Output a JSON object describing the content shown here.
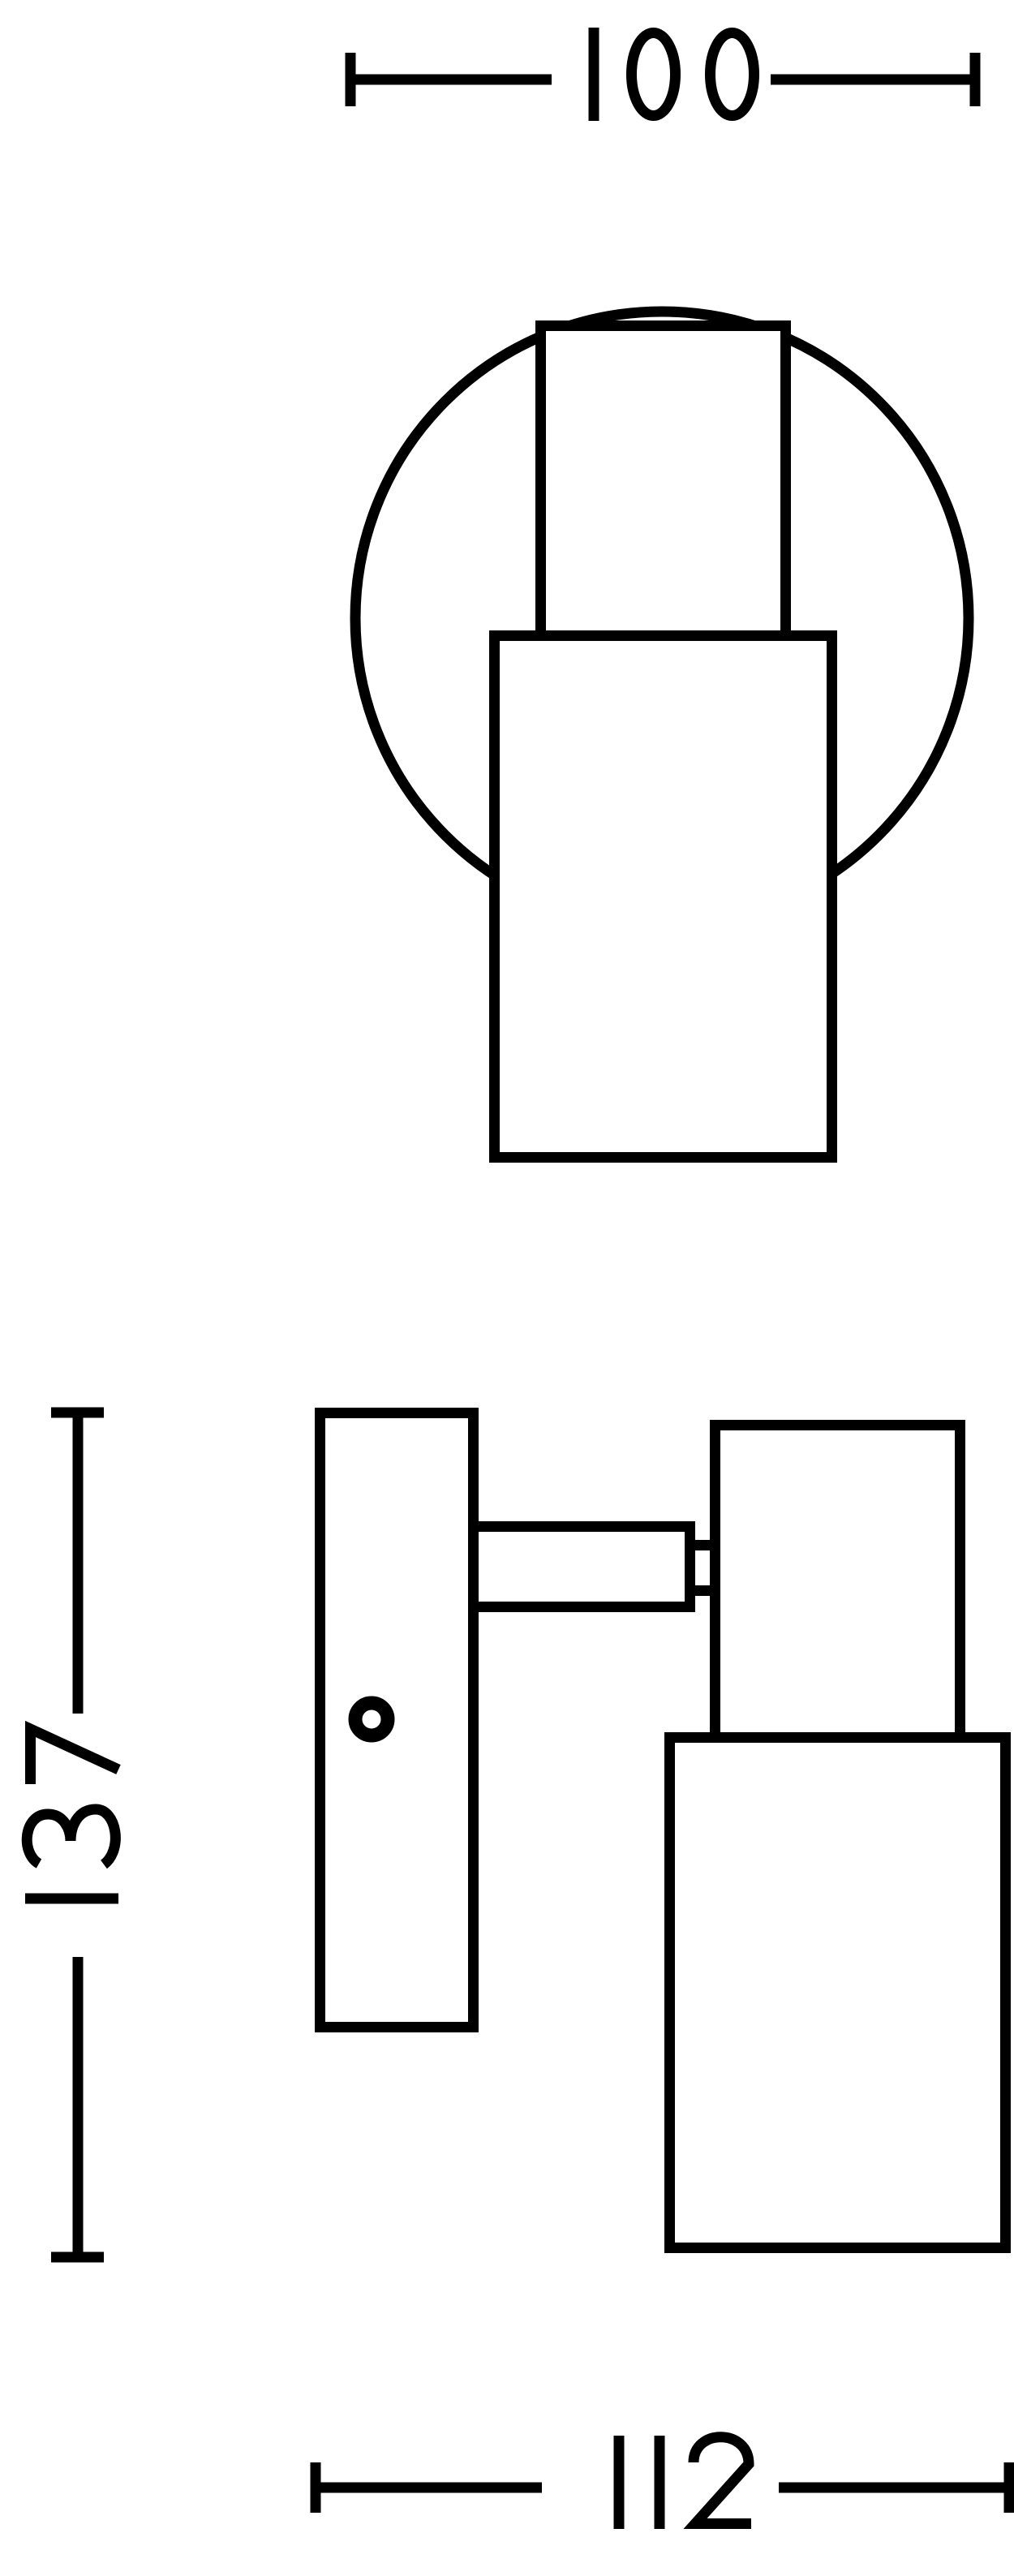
{
  "drawing": {
    "canvas_color": "#ffffff",
    "line_color": "#000000",
    "views": {
      "top": {
        "label": "top-view",
        "parts": [
          "wall-plate-circle",
          "lamp-head-cylinder",
          "lamp-body-cylinder"
        ]
      },
      "side": {
        "label": "side-view",
        "parts": [
          "wall-plate",
          "screw-hole",
          "mounting-arm",
          "pivot-neck",
          "lamp-head-cylinder",
          "lamp-body-cylinder"
        ]
      }
    },
    "dimensions": {
      "top_width": {
        "value": "100"
      },
      "side_height": {
        "value": "137"
      },
      "bottom_width": {
        "value": "112"
      }
    }
  }
}
